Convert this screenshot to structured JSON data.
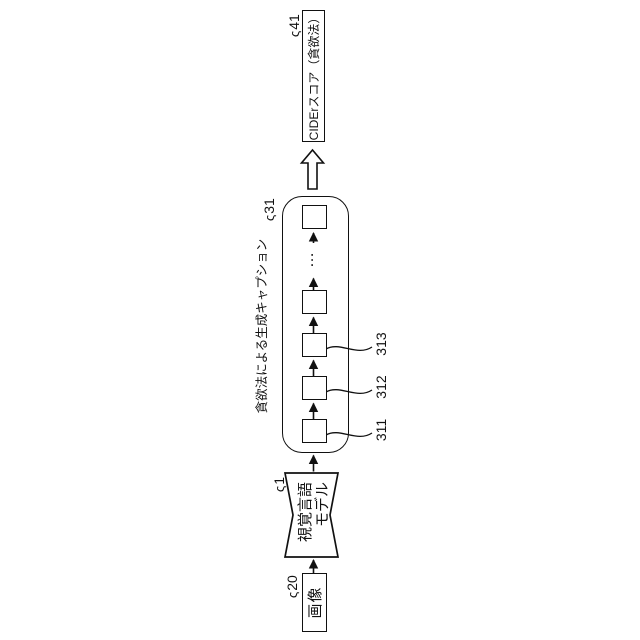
{
  "figure": {
    "background": "#ffffff",
    "line_color": "#111111",
    "ref_leader_glyph": "ς",
    "nodes": {
      "image_box": {
        "label": "画像",
        "ref": "20"
      },
      "model": {
        "line1": "視覚言語",
        "line2": "モデル",
        "ref": "1"
      },
      "caption_group": {
        "label": "貪欲法による生成キャプション",
        "ref": "31",
        "ellipsis": "…",
        "token_refs": [
          "311",
          "312",
          "313"
        ]
      },
      "score_box": {
        "label": "CIDErスコア（貪欲法）",
        "ref": "41"
      }
    }
  }
}
